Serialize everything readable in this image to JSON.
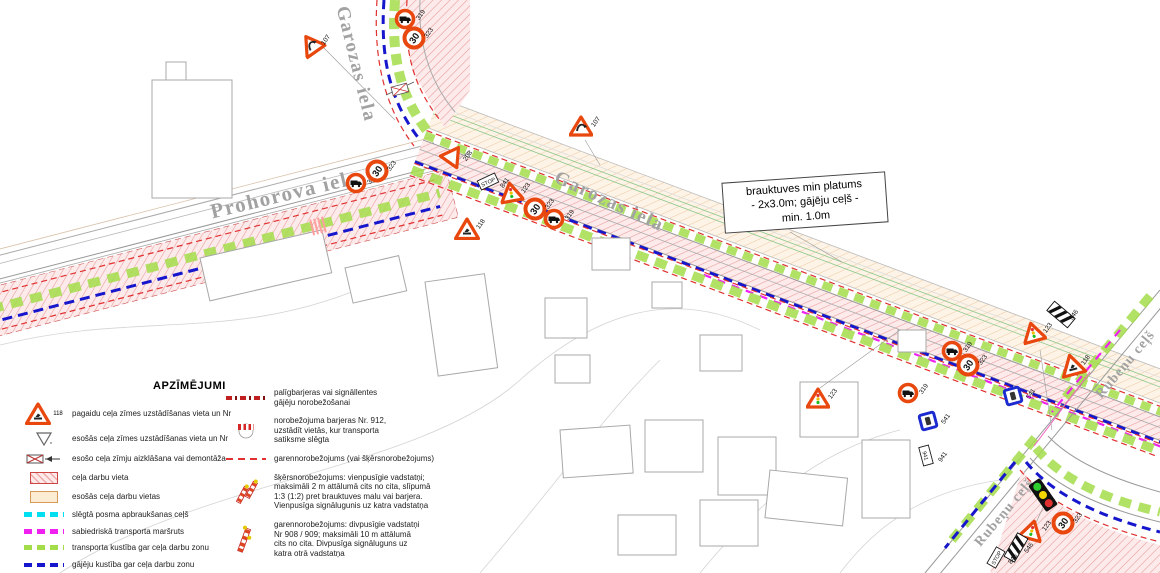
{
  "streets": {
    "prohorova": "Prohorova iela",
    "garozas_top": "Garozas iela",
    "garozas_mid": "Garozas iela",
    "rubenu_right": "Rubeņu ceļš",
    "rubenu_bottom": "Rubeņu ceļš"
  },
  "annotation": {
    "lines": [
      "brauktuves min platums",
      "- 2x3.0m; gājēju ceļš -",
      "min. 1.0m"
    ]
  },
  "legend": {
    "title": "APZĪMĒJUMI",
    "col1": [
      {
        "icon": "works-sign",
        "icon_label": "118",
        "label": "pagaidu ceļa zīmes uzstādīšanas vieta un Nr"
      },
      {
        "icon": "existing-sign-triangle",
        "icon_label": "nr",
        "label": "esošās ceļa zīmes uzstādīšanas vieta un Nr"
      },
      {
        "icon": "sign-removal",
        "label": "esošo ceļa zīmju aizklāšana vai demontāža"
      },
      {
        "icon": "pink-hatch",
        "label": "ceļa darbu vieta"
      },
      {
        "icon": "peach-fill",
        "label": "esošās ceļa darbu vietas"
      },
      {
        "icon": "cyan-dash",
        "label": "slēgtā posma apbraukšanas ceļš"
      },
      {
        "icon": "magenta-dash",
        "label": "sabiedriskā transporta maršruts"
      },
      {
        "icon": "green-dash",
        "label": "transporta kustība gar ceļa darbu zonu"
      },
      {
        "icon": "blue-dash",
        "label": "gājēju kustība gar ceļa darbu zonu"
      }
    ],
    "col2": [
      {
        "icon": "red-dashdot",
        "label": "palīgbarjeras vai signāllentes\ngājēju norobežošanai"
      },
      {
        "icon": "barrier-912",
        "label": "norobežojuma barjeras Nr. 912,\nuzstādīt vietās, kur transporta\nsatiksme slēgta"
      },
      {
        "icon": "red-dash",
        "label": "garennorobežojums (vai šķērsnorobežojums)"
      },
      {
        "icon": "posts-single",
        "label": "šķērsnorobežojums: vienpusīgie vadstatņi;\nmaksimāli 2 m attālumā cits no cita, slīpumā\n1:3 (1:2) pret brauktuves malu vai barjera.\nVienpusīga signālugunis uz katra vadstatņa"
      },
      {
        "icon": "posts-double",
        "label": "garennorobežojums: divpusīgie vadstatņi\nNr 908 / 909; maksimāli 10 m attālumā\ncits no cita. Divpusīga signāluguns uz\nkatra otrā vadstatņa"
      }
    ]
  },
  "signs": [
    {
      "type": "circle-truck",
      "x": 394,
      "y": 8,
      "label": "319"
    },
    {
      "type": "circle-30",
      "text": "30",
      "x": 402,
      "y": 26,
      "label": "323",
      "rot": -55
    },
    {
      "type": "tri-curve",
      "x": 299,
      "y": 33,
      "label": "107",
      "rot": -35
    },
    {
      "type": "circle-truck",
      "x": 345,
      "y": 172,
      "label": "319"
    },
    {
      "type": "circle-30",
      "text": "30",
      "x": 365,
      "y": 159,
      "label": "323",
      "rot": -55
    },
    {
      "type": "tri-yield",
      "x": 441,
      "y": 149,
      "label": "208",
      "rot": -25
    },
    {
      "type": "rect-sign",
      "text": "STOP",
      "x": 478,
      "y": 176,
      "label": "841",
      "rot": -25
    },
    {
      "type": "tri-signal",
      "x": 499,
      "y": 181,
      "label": "123",
      "rot": -10
    },
    {
      "type": "tri-works",
      "x": 454,
      "y": 217,
      "label": "118"
    },
    {
      "type": "circle-30",
      "text": "30",
      "x": 523,
      "y": 197,
      "label": "323",
      "rot": -55
    },
    {
      "type": "circle-truck",
      "x": 543,
      "y": 208,
      "label": "319"
    },
    {
      "type": "tri-curve",
      "x": 569,
      "y": 115,
      "label": "107"
    },
    {
      "type": "tri-signal",
      "x": 806,
      "y": 387,
      "label": "123"
    },
    {
      "type": "circle-truck",
      "x": 941,
      "y": 340,
      "label": "319"
    },
    {
      "type": "circle-30",
      "text": "30",
      "x": 956,
      "y": 353,
      "label": "323",
      "rot": -55
    },
    {
      "type": "tri-signal",
      "x": 1021,
      "y": 321,
      "label": "123",
      "rot": -15
    },
    {
      "type": "stripe-sign",
      "x": 1047,
      "y": 308,
      "label": "546",
      "rot": 40
    },
    {
      "type": "tri-works",
      "x": 1059,
      "y": 353,
      "label": "118",
      "rot": -15
    },
    {
      "type": "circle-truck",
      "x": 897,
      "y": 382,
      "label": "319"
    },
    {
      "type": "blue-square",
      "x": 919,
      "y": 412,
      "label": "541",
      "rot": -15
    },
    {
      "type": "blue-square",
      "x": 1004,
      "y": 387,
      "label": "541",
      "rot": -15
    },
    {
      "type": "rect-sign",
      "text": "941",
      "x": 916,
      "y": 450,
      "label": "941",
      "rot": 75
    },
    {
      "type": "traffic-light",
      "x": 1035,
      "y": 478,
      "rot": -35
    },
    {
      "type": "tri-signal",
      "x": 1020,
      "y": 519,
      "label": "123",
      "rot": 15
    },
    {
      "type": "stripe-sign",
      "x": 1002,
      "y": 541,
      "label": "546",
      "rot": -60
    },
    {
      "type": "rect-sign",
      "text": "STOP",
      "x": 986,
      "y": 552,
      "label": "846",
      "rot": -60
    },
    {
      "type": "circle-30",
      "text": "30",
      "x": 1051,
      "y": 511,
      "label": "323",
      "rot": -55
    }
  ],
  "colors": {
    "sign_red": "#e8470e",
    "works_pink": "#f0aaaa",
    "existing_peach": "#fcecd4",
    "detour_cyan": "#00dff0",
    "transit_magenta": "#f020f0",
    "traffic_green": "#a3dd4a",
    "pedestrian_blue": "#1616cc",
    "barrier_red": "#e03030"
  }
}
